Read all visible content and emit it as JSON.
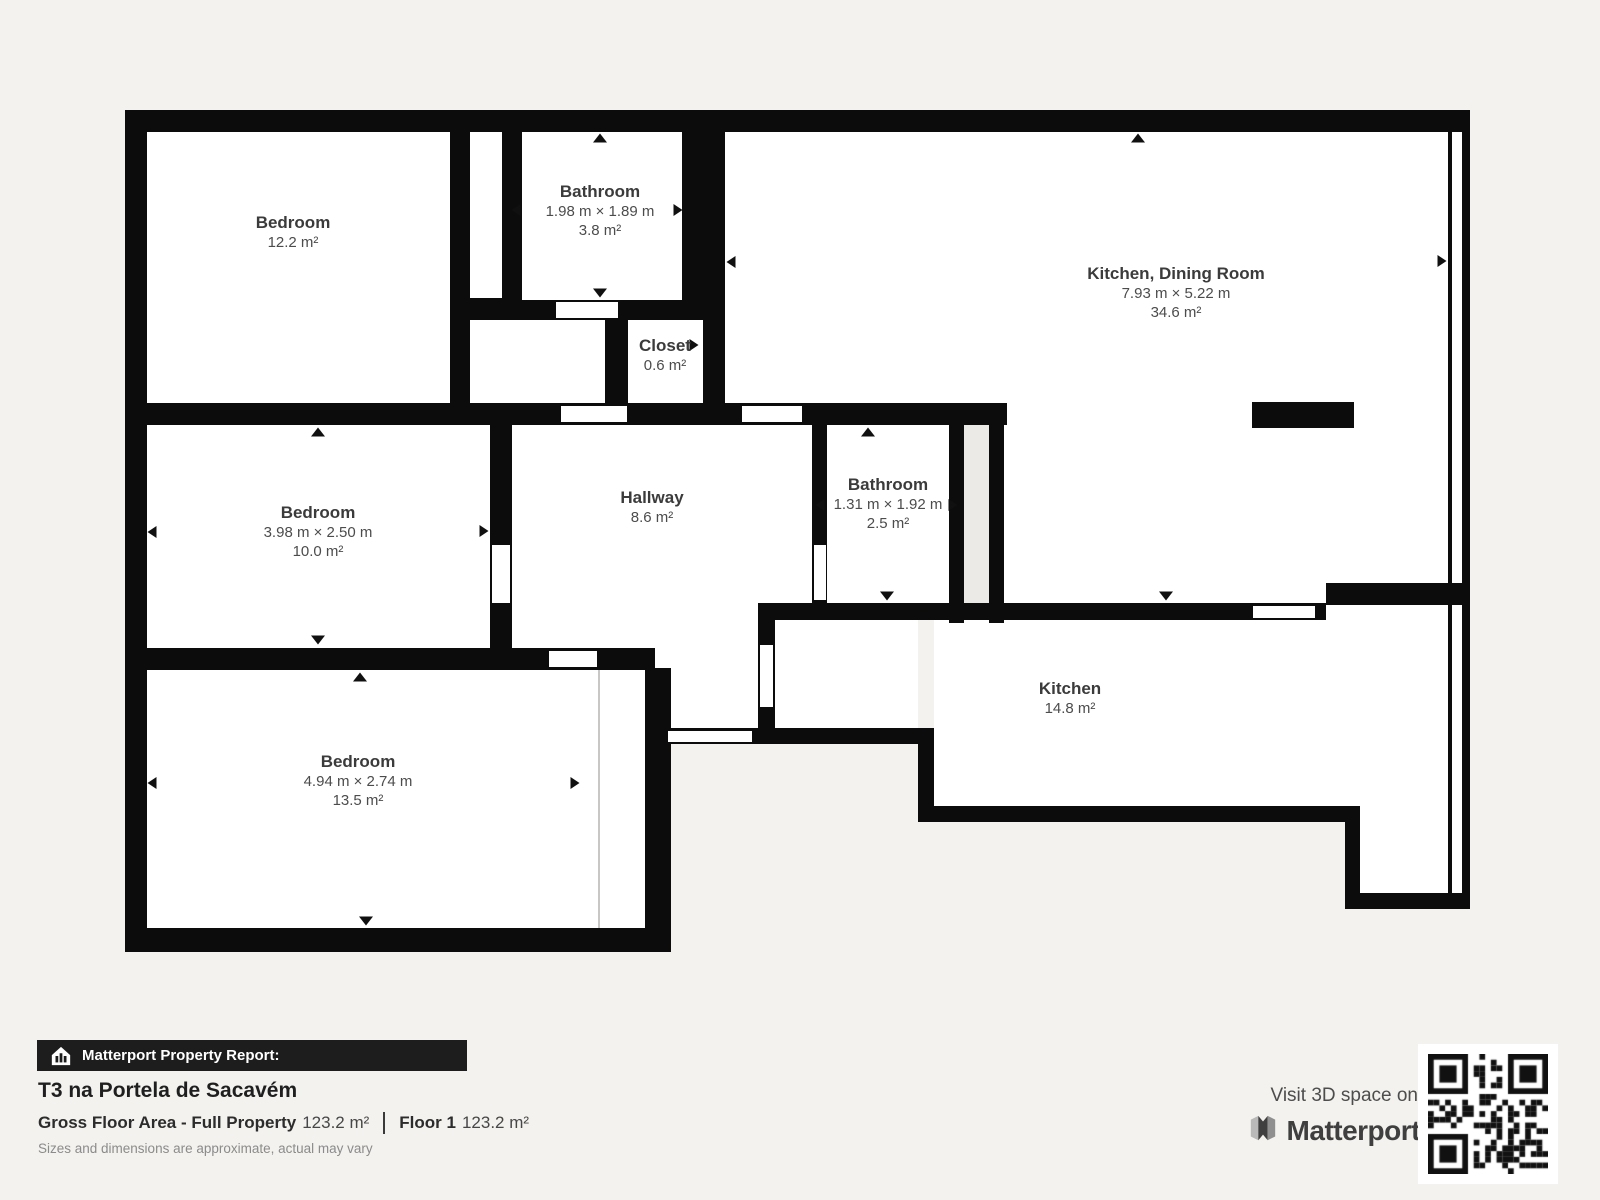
{
  "plan": {
    "rooms": [
      {
        "id": "bedroom-1",
        "name": "Bedroom",
        "dimensions": "",
        "area": "12.2 m²"
      },
      {
        "id": "bathroom-1",
        "name": "Bathroom",
        "dimensions": "1.98 m × 1.89 m",
        "area": "3.8 m²"
      },
      {
        "id": "kitchen-dining-room",
        "name": "Kitchen, Dining Room",
        "dimensions": "7.93 m × 5.22 m",
        "area": "34.6 m²"
      },
      {
        "id": "closet",
        "name": "Closet",
        "dimensions": "",
        "area": "0.6 m²"
      },
      {
        "id": "bedroom-2",
        "name": "Bedroom",
        "dimensions": "3.98 m × 2.50 m",
        "area": "10.0 m²"
      },
      {
        "id": "hallway",
        "name": "Hallway",
        "dimensions": "",
        "area": "8.6 m²"
      },
      {
        "id": "bathroom-2",
        "name": "Bathroom",
        "dimensions": "1.31 m × 1.92 m",
        "area": "2.5 m²"
      },
      {
        "id": "kitchen",
        "name": "Kitchen",
        "dimensions": "",
        "area": "14.8 m²"
      },
      {
        "id": "bedroom-3",
        "name": "Bedroom",
        "dimensions": "4.94 m × 2.74 m",
        "area": "13.5 m²"
      }
    ]
  },
  "report": {
    "bar_label": "Matterport Property Report:",
    "title": "T3 na Portela de Sacavém",
    "gross_label": "Gross Floor Area - Full Property",
    "gross_value": "123.2 m²",
    "floor_label": "Floor 1",
    "floor_value": "123.2 m²",
    "disclaimer": "Sizes and dimensions are approximate, actual may vary"
  },
  "footer_right": {
    "visit_text": "Visit 3D space on",
    "brand": "Matterport"
  },
  "colors": {
    "background": "#f3f2ef",
    "wall": "#0c0c0c",
    "floor": "#ffffff",
    "report_bar": "#1d1d1d",
    "label_text": "#3b3b3b"
  }
}
